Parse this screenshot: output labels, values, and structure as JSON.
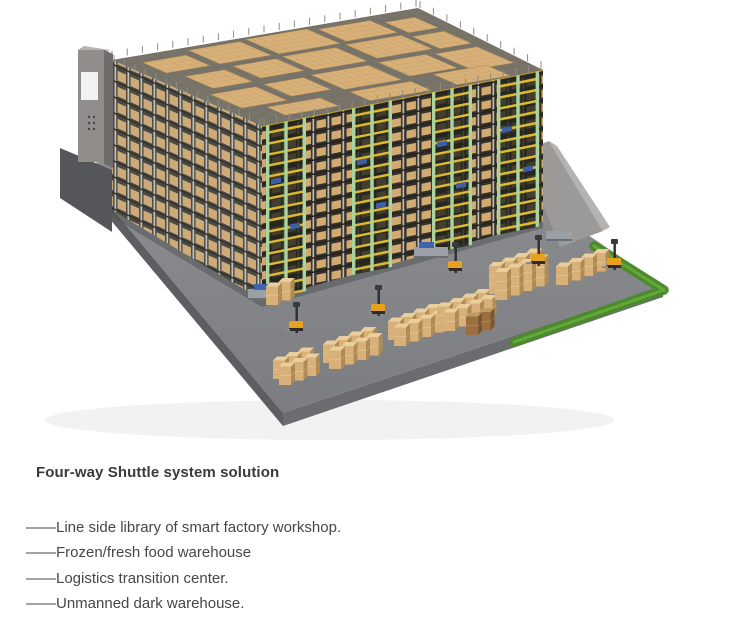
{
  "content": {
    "heading": "Four-way Shuttle system solution",
    "items": [
      "——Line side library of smart factory workshop.",
      "——Frozen/fresh food warehouse",
      "——Logistics transition center.",
      "——Unmanned dark warehouse."
    ]
  },
  "illustration": {
    "alt": "3D render of an automated four-way shuttle warehouse: dense racking filled with tan cartons, green shuttle lift towers with yellow rails, a gray control tower, pallet stacks and yellow forklifts on a gray platform edged with grass",
    "colors": {
      "box_tan": "#d7b179",
      "box_top": "#eacf9d",
      "rack_green": "#abd3a0",
      "rail_yellow": "#dcb92f",
      "floor": "#86888b",
      "floor_edge": "#5c5e61",
      "grass": "#4c8a2e",
      "roof": "#787469",
      "rack_dark": "#34332e",
      "tower_gray": "#908d8b",
      "forklift_yellow": "#e8a11c"
    }
  }
}
